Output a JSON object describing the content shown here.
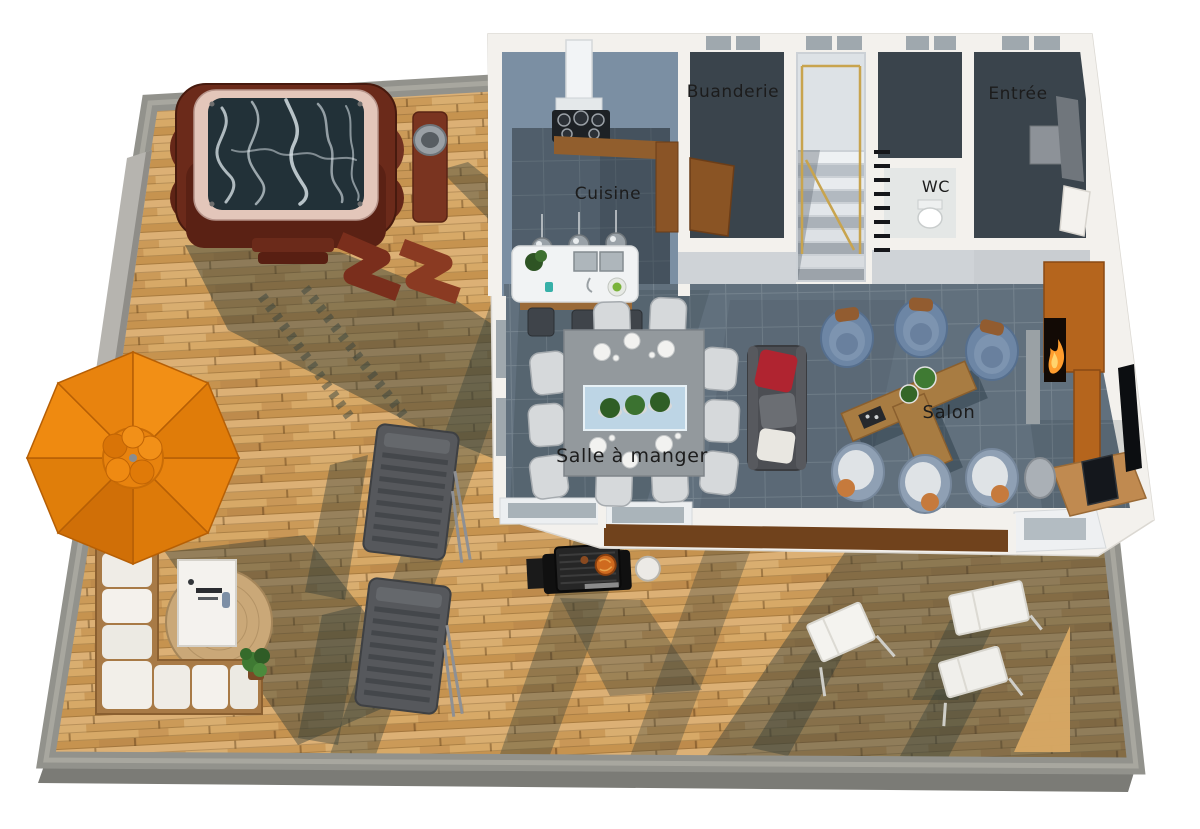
{
  "scene": {
    "description": "3D rendered ground-floor plan of a house with large outdoor wooden deck, viewed from above",
    "language": "fr"
  },
  "labels": {
    "buanderie": "Buanderie",
    "entree": "Entrée",
    "cuisine": "Cuisine",
    "wc": "WC",
    "salon": "Salon",
    "salle_a_manger": "Salle à manger"
  },
  "rooms": [
    {
      "id": "buanderie",
      "label": "Buanderie"
    },
    {
      "id": "entree",
      "label": "Entrée"
    },
    {
      "id": "cuisine",
      "label": "Cuisine"
    },
    {
      "id": "wc",
      "label": "WC"
    },
    {
      "id": "salon",
      "label": "Salon"
    },
    {
      "id": "salle-a-manger",
      "label": "Salle à manger"
    }
  ],
  "objects": {
    "outdoor": [
      "hot-tub",
      "folded-deck-loungers",
      "service-stand",
      "planter-wall",
      "parasol",
      "outdoor-corner-sofa",
      "rattan-ottoman",
      "outdoor-table",
      "potted-plant",
      "sun-loungers",
      "barbecue",
      "side-tray",
      "folding-chairs"
    ],
    "indoor": [
      "cooktop",
      "extractor-hood",
      "kitchen-counter",
      "pantry-cabinet",
      "kitchen-island",
      "island-sinks",
      "pendant-lights",
      "bar-stools",
      "laundry-door",
      "staircase",
      "stair-railing",
      "toilet",
      "entry-sideboard",
      "entry-door",
      "dining-table",
      "table-runner",
      "dining-chairs",
      "plates",
      "plants-centerpiece",
      "sofa",
      "red-cushion",
      "white-cushion",
      "tub-armchairs",
      "coffee-table",
      "fireplace-media-unit",
      "desk",
      "monitor",
      "desk-chair",
      "wall-tv",
      "window-band",
      "sliding-doors"
    ]
  },
  "colors": {
    "deck_wood": "#cf9f5d",
    "deck_wood_dark": "#b9854a",
    "deck_border_concrete": "#92928c",
    "house_wall": "#f3f1ed",
    "interior_tile_floor": "#61707d",
    "kitchen_wall_blue": "#7b8fa3",
    "dark_room_floor": "#3a444c",
    "hot_tub_wood": "#6b2a1a",
    "hot_tub_rim": "#e3c6ba",
    "parasol_orange": "#e8830e",
    "armchair_blue": "#6d86a5",
    "armchair_light": "#8fa0b4",
    "sofa_gray": "#4c4e53",
    "cushion_red": "#b02430",
    "coffee_table_wood": "#a87c42",
    "media_unit_wood": "#b5651d",
    "fire_glow": "#ff9d2e",
    "stair_railing_gold": "#c8a44e",
    "label_text": "#1c1c1c"
  }
}
